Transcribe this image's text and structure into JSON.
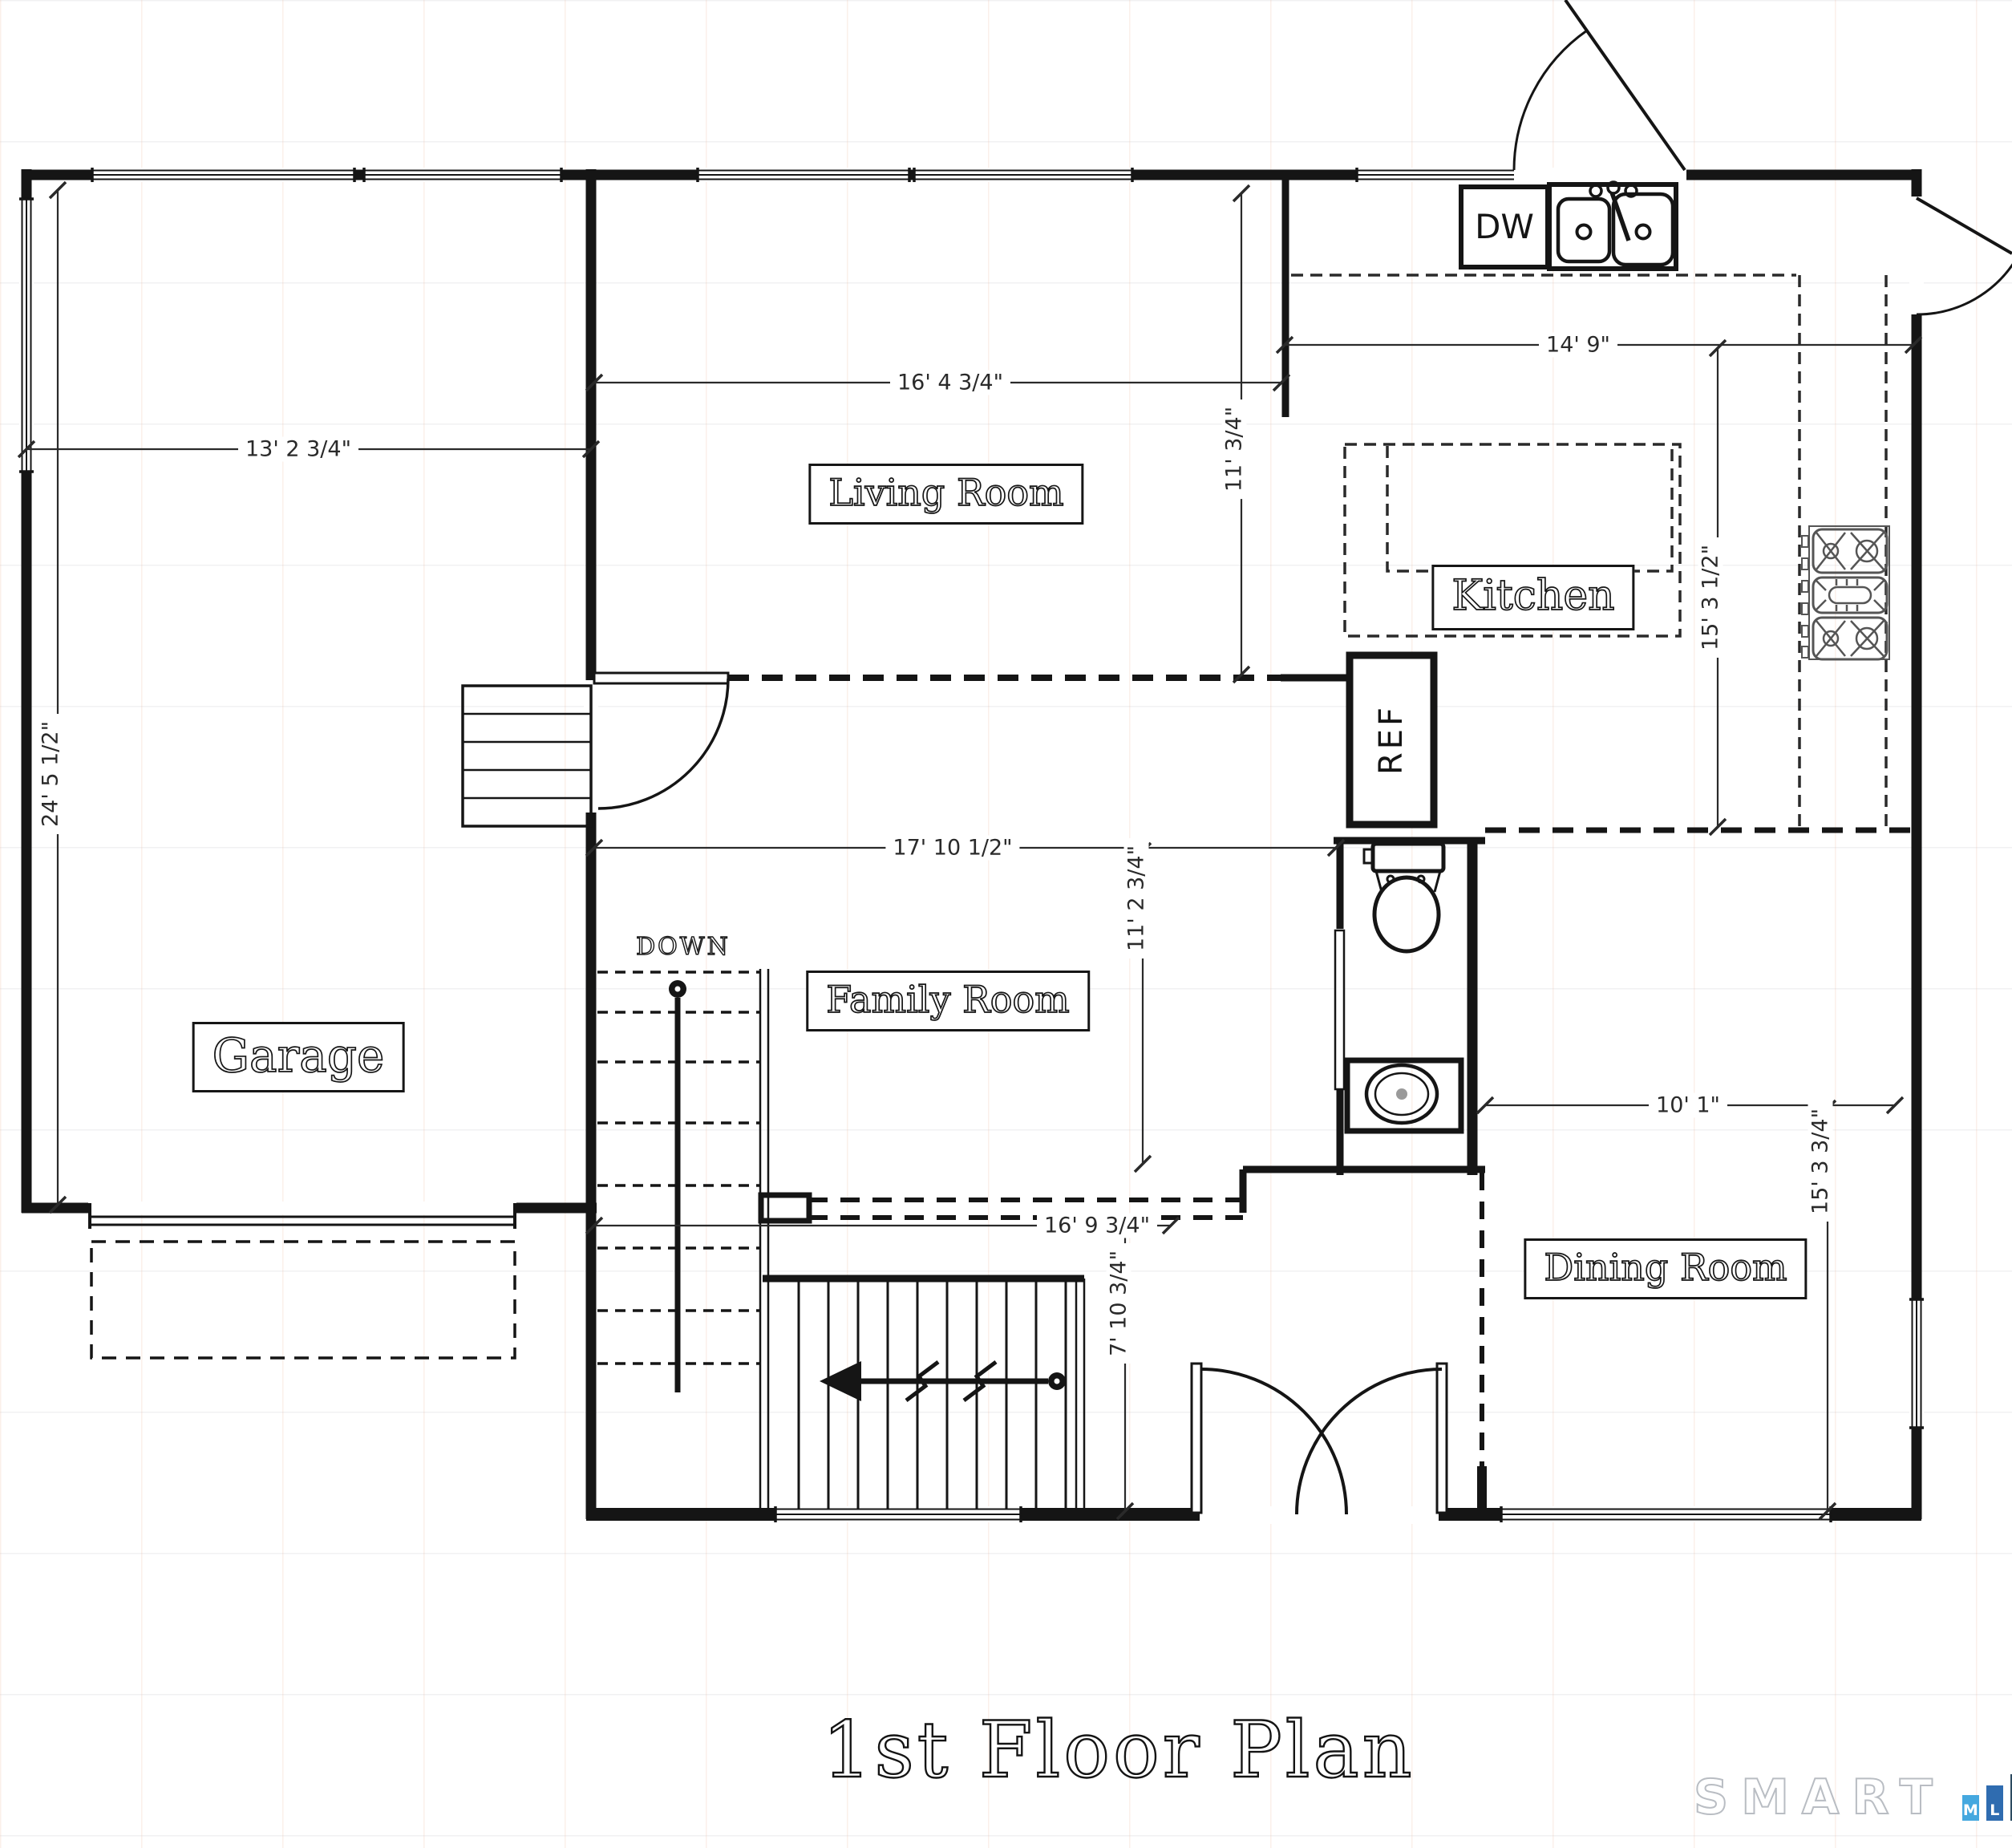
{
  "title": "1st Floor Plan",
  "rooms": {
    "living": "Living Room",
    "kitchen": "Kitchen",
    "garage": "Garage",
    "family": "Family Room",
    "dining": "Dining Room"
  },
  "annotations": {
    "down": "DOWN",
    "ref": "REF",
    "dw": "DW"
  },
  "dimensions": {
    "garage_width": "13' 2 3/4\"",
    "garage_depth": "24' 5 1/2\"",
    "living_width": "16' 4 3/4\"",
    "living_depth": "11' 3/4\"",
    "kitchen_width": "14' 9\"",
    "kitchen_depth": "15' 3 1/2\"",
    "family_width": "17' 10 1/2\"",
    "family_depth": "11' 2 3/4\"",
    "dining_width": "10' 1\"",
    "dining_depth": "15' 3 3/4\"",
    "hall_width": "16' 9 3/4\"",
    "vestibule_depth": "7' 10 3/4\""
  },
  "logo": {
    "word": "SMART",
    "bars": [
      {
        "letter": "M",
        "color": "#45a8df"
      },
      {
        "letter": "L",
        "color": "#2f6cb0"
      },
      {
        "letter": "S",
        "color": "#2c4a60"
      }
    ]
  },
  "colors": {
    "wall_line": "#151515",
    "dim_line": "#2a2a2a",
    "logo_outline": "#b9bdc3"
  }
}
